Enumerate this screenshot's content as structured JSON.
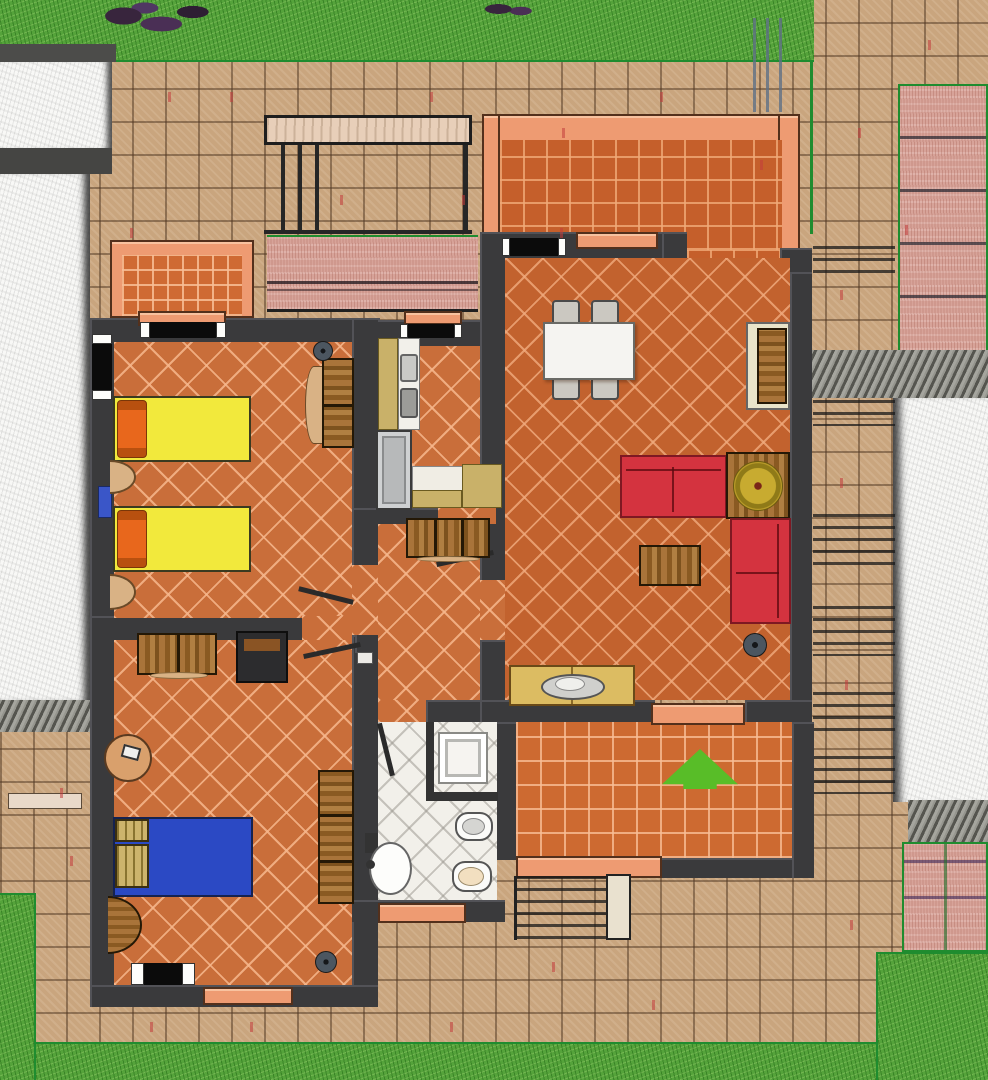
{
  "scene": {
    "kind": "architectural floor plan",
    "view": "top-down",
    "description": "Furnished one-storey apartment plan: twin bedroom, master bedroom, kitchen, hallway, bathroom and living-dining room, with an upper terrace, entry porch with direction arrow, outdoor stairs, paved patios, lawns and neighbouring buildings."
  },
  "colors": {
    "wall": "#3a3a3c",
    "floorTile": "#c96e3a",
    "livingTile": "#c2622e",
    "bathTile": "#f2f0ea",
    "terraceTile": "#cd6a31",
    "patio": "#c9a57e",
    "grass": "#55a33b",
    "penGreen": "#1f8c2f",
    "salmon": "#ee9b72",
    "pink": "#d7a399",
    "white": "#f8f8f6",
    "khaki": "#c9b169",
    "yellowBed": "#f2e93c",
    "orangePillow": "#e8671c",
    "blueBed": "#2b49c4",
    "blueRadiator": "#3a56c8",
    "redSofa": "#d4333f",
    "cream": "#e9e4ca",
    "applianceGray": "#b7b9ba",
    "gold": "#c8ab30",
    "arrowGreen": "#58bd28"
  },
  "rooms": [
    "twin-bedroom",
    "master-bedroom",
    "kitchen",
    "hallway",
    "bathroom",
    "living-dining-room",
    "upper-terrace",
    "entry-porch"
  ],
  "furniture": [
    "twin-bed-1",
    "twin-bed-2",
    "orange-pillows",
    "nightstand-1",
    "nightstand-2",
    "dresser",
    "ceiling-lamp-1",
    "desk-cabinet",
    "dark-armchair",
    "round-side-table",
    "double-bed",
    "wicker-pillows",
    "wardrobe",
    "bedroom-lamp",
    "kitchen-tall-cabinet",
    "kitchen-sink-unit",
    "kitchen-stove",
    "refrigerator",
    "kitchen-counter",
    "hall-sideboard",
    "shower",
    "bidet",
    "toilet",
    "washbasin",
    "dining-table",
    "dining-chairs",
    "dining-sideboard",
    "sofa-horizontal",
    "sofa-vertical",
    "corner-table-with-gold-disc",
    "coffee-table",
    "console-table-with-platter",
    "floor-lamp"
  ],
  "environment": [
    "lawn-top",
    "lawn-bottom",
    "lawn-left",
    "lawn-right",
    "shrub",
    "paved-patio",
    "neighbour-building-left",
    "neighbour-building-right",
    "outdoor-stairs-right",
    "pink-terrace-right",
    "pink-planter-strip",
    "pergola-beam",
    "left-terrace",
    "entry-steps",
    "newel-post",
    "entrance-arrow"
  ]
}
